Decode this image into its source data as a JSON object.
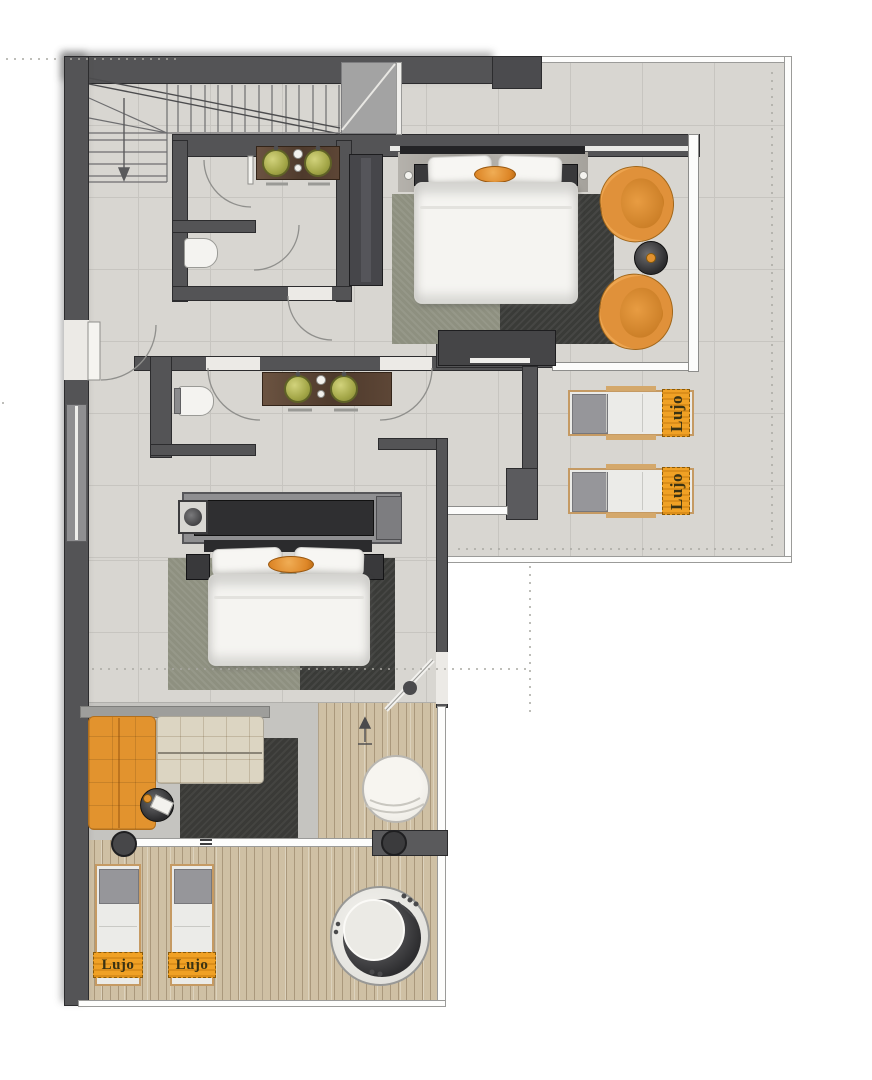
{
  "scene": {
    "type": "architectural floor plan, top view",
    "brand_label": "Lujo"
  },
  "labels": {
    "towel_terrace_1": "Lujo",
    "towel_terrace_2": "Lujo",
    "towel_deck_1": "Lujo",
    "towel_deck_2": "Lujo"
  },
  "palette": {
    "outside": "#ffffff",
    "wall": "#545456",
    "wall_dark": "#47474a",
    "tile_floor": "#d8d6d1",
    "tile_grout": "#c7c5c0",
    "deck_wood": "#cfc0a4",
    "deck_plank_line": "#b4a585",
    "parapet_line": "#9b9b99",
    "accent_orange": "#e2922f",
    "towel_orange": "#f0a125",
    "rug_sage": "#8e9080",
    "rug_charcoal": "#3a3b38",
    "bedding_white": "#f5f4f1",
    "sofa_beige": "#dcd5c2",
    "vanity_wood": "#5d4837",
    "sink_green": "#a2a546",
    "lounger_head_gray": "#96969a",
    "living_rug_gray": "#c5c4c0"
  }
}
